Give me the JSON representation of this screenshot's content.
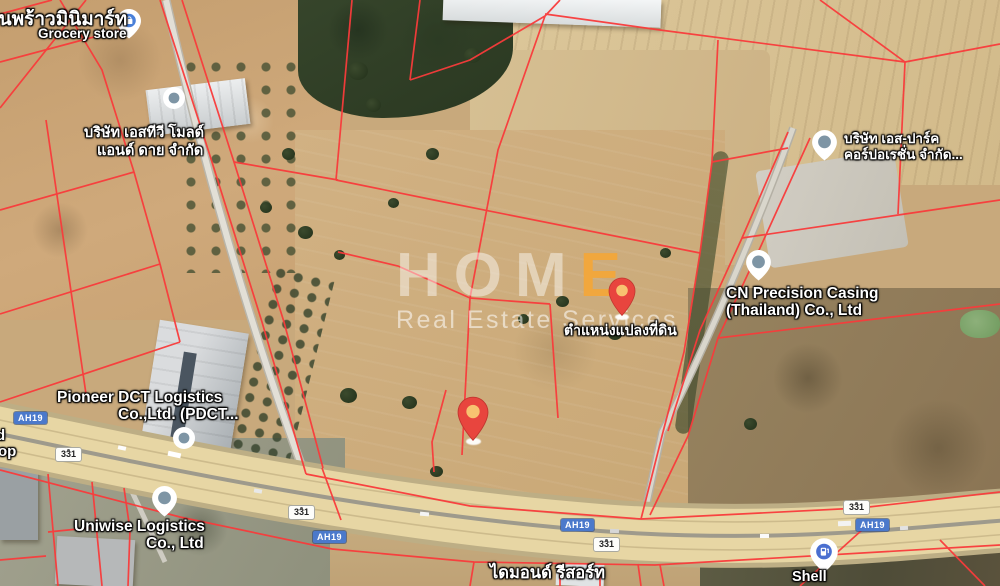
{
  "map_type": "satellite",
  "colors": {
    "cadastral_line": "#f93b3b",
    "marker_red": "#e8453e",
    "marker_inner": "#f8c270",
    "badge_blue": "#4b79cb",
    "watermark_accent": "#f2a73a"
  },
  "watermark": {
    "brand_prefix": "HOM",
    "brand_accent": "E",
    "subtitle": "Real Estate Services"
  },
  "badges": {
    "ah19": "AH19",
    "route331": "331"
  },
  "pois": {
    "grocery": {
      "line1": "านพร้าวมินิมาร์ท",
      "line2": "Grocery store",
      "icon": "shopping-pin"
    },
    "stv": {
      "line1": "บริษัท เอสทีวี โมลด์",
      "line2": "แอนด์ ดาย จำกัด",
      "icon": "poi-dot"
    },
    "spark": {
      "line1": "บริษัท เอส-ปาร์ค",
      "line2": "คอร์ปอเรชั่น จำกัด...",
      "icon": "poi-pin"
    },
    "cn": {
      "line1": "CN Precision Casing",
      "line2": "(Thailand) Co., Ltd",
      "icon": "poi-pin"
    },
    "pioneer": {
      "line1": "Pioneer DCT Logistics",
      "line2": "Co.,Ltd. (PDCT...",
      "icon": "poi-dot"
    },
    "uniwise": {
      "line1": "Uniwise Logistics",
      "line2": "Co., Ltd",
      "icon": "poi-pin"
    },
    "resort": {
      "line1": "ไดมอนด์ รีสอร์ท"
    },
    "shell": {
      "line1": "Shell",
      "icon": "fuel-pin"
    },
    "plot": {
      "line1": "ตำแหน่งแปลงที่ดิน",
      "icon": "red-pin"
    },
    "edge_partial": {
      "line1": "d",
      "line2": "op"
    }
  }
}
